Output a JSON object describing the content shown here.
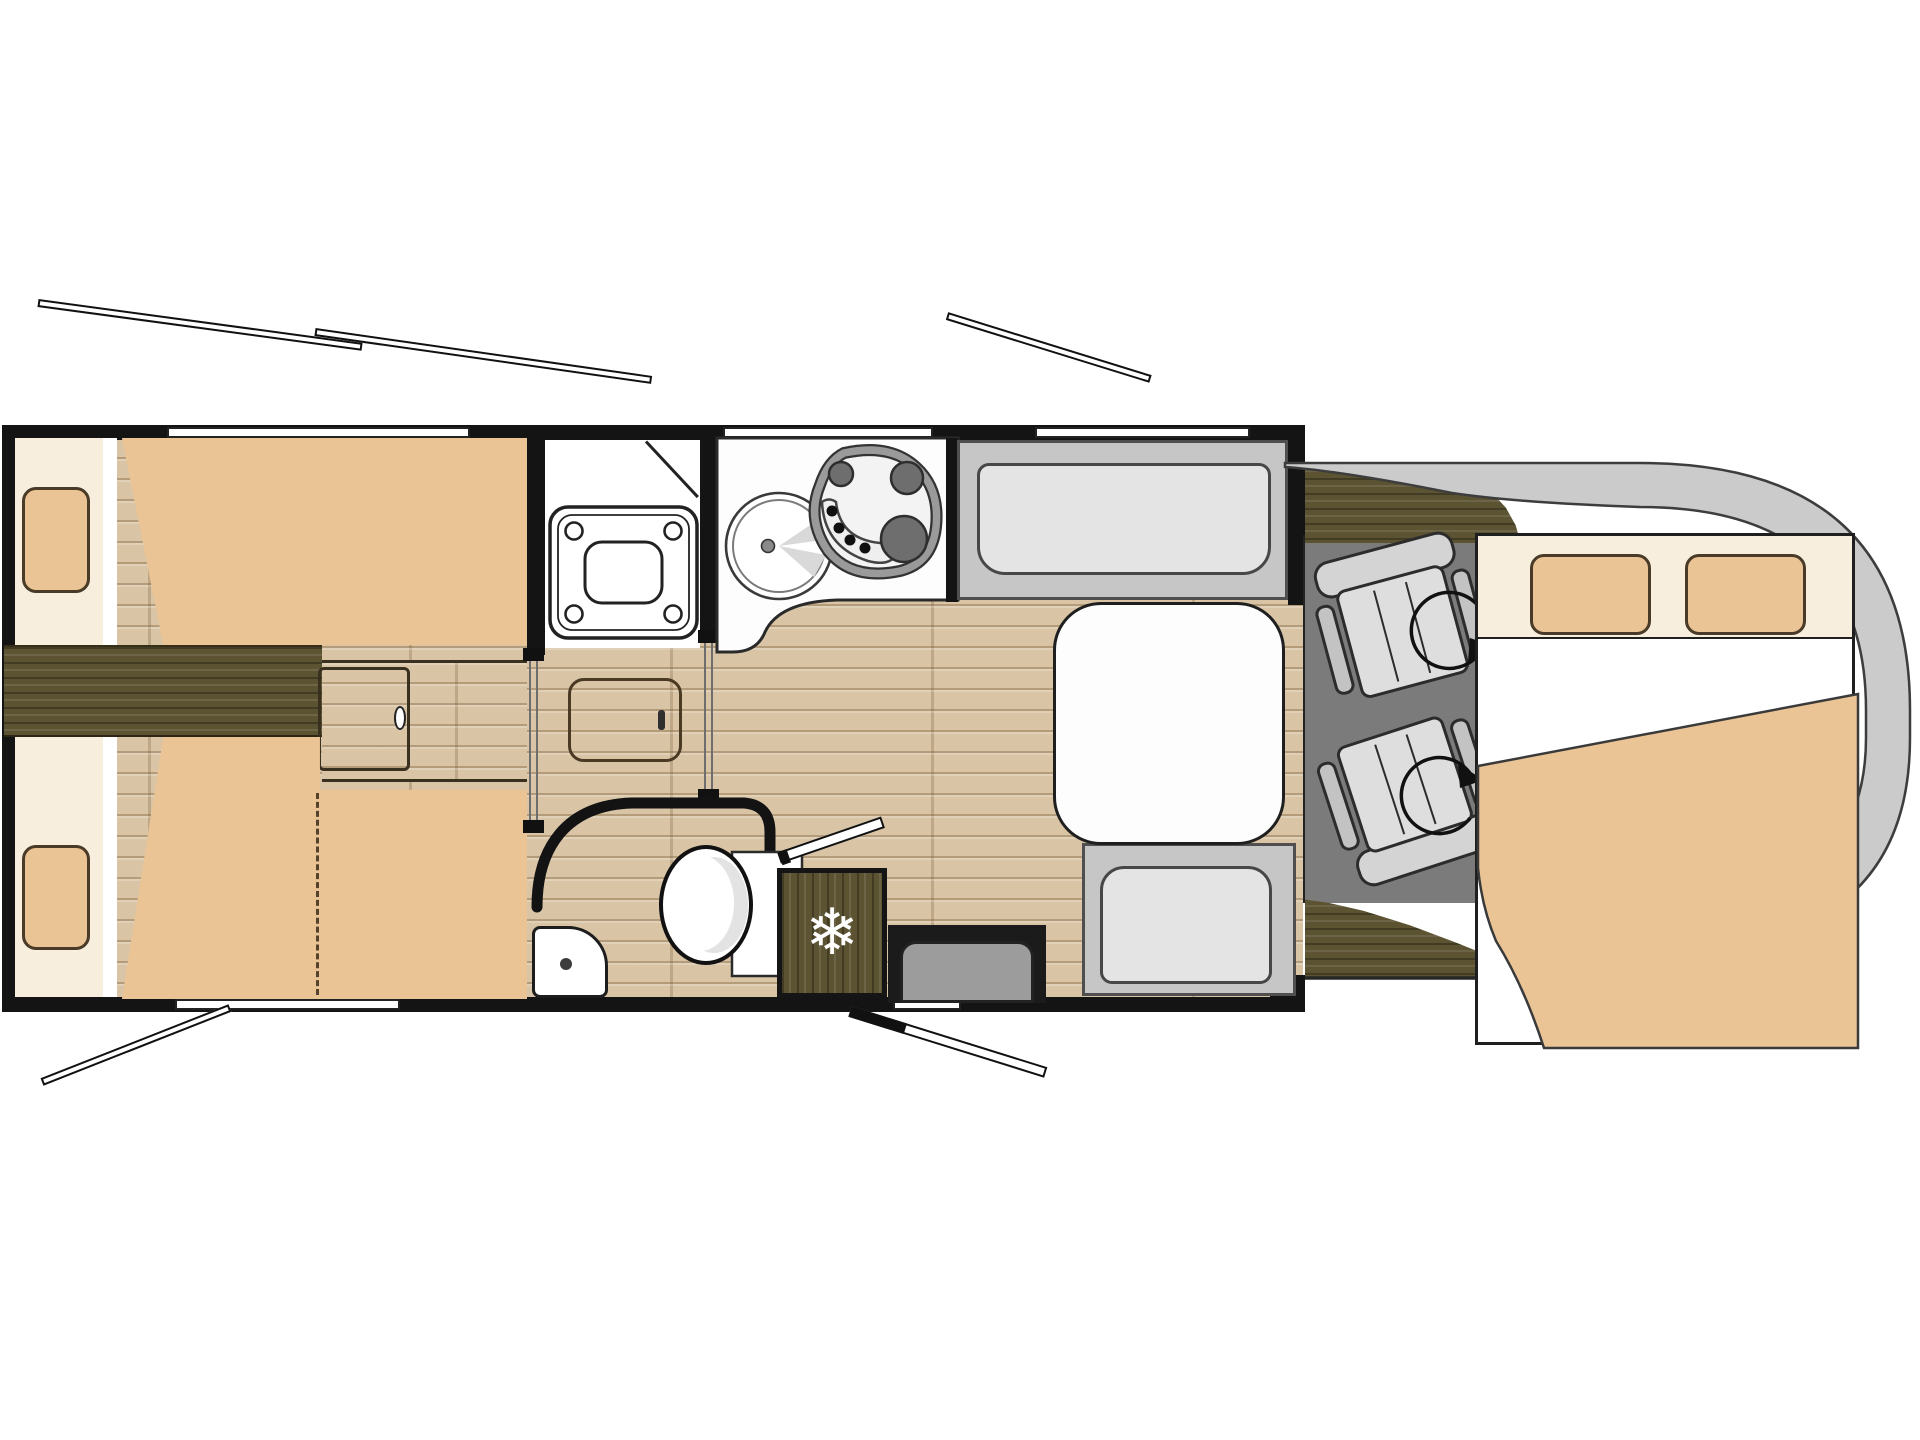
{
  "diagram": {
    "kind": "motorhome-floorplan",
    "view": "top-down",
    "vehicle_zones": [
      "rear-twin-beds",
      "wardrobe-shower",
      "kitchen",
      "washroom",
      "fridge",
      "entry-door",
      "dinette",
      "cab-swivel-seats",
      "overcab-bed"
    ]
  },
  "icons": {
    "fridge_snowflake": "❄"
  },
  "palette": {
    "white": "#ffffff",
    "wall": "#141414",
    "outline": "#222222",
    "tan": "#ebc496",
    "cream": "#f8eedd",
    "wood": "#d9c5a6",
    "walnut": "#5c5332",
    "bench": "#c6c6c6",
    "cushion": "#e4e4e4",
    "cab_floor": "#7b7b7b",
    "seat_gray": "#d8d8d8",
    "body_band": "#cbcbcb",
    "counter": "#fdfdfd",
    "step_gray": "#9c9c9c"
  }
}
